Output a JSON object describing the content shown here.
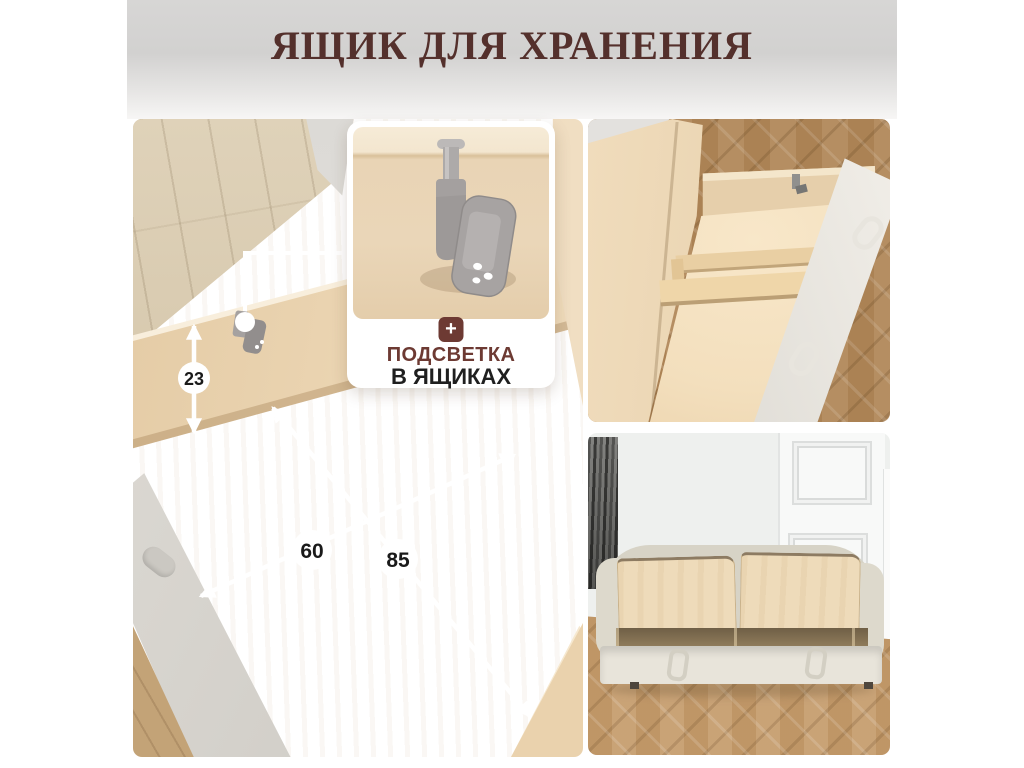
{
  "header": {
    "title": "ЯЩИК ДЛЯ ХРАНЕНИЯ",
    "title_color": "#54302c"
  },
  "callout": {
    "plus": "+",
    "line1": "ПОДСВЕТКА",
    "line2": "В ЯЩИКАХ",
    "accent_color": "#6d3a33",
    "card_background": "#ffffff"
  },
  "dimensions": {
    "height": "23",
    "width": "60",
    "depth": "85"
  },
  "icons": {
    "plus": "plus-icon",
    "sensor": "drawer-light-sensor-icon"
  },
  "colors": {
    "header_gray_top": "#d7d6d5",
    "header_gray_bottom": "#f7f6f5",
    "plywood": "#f0dcbd",
    "oak_floor_light": "#d6c7ac",
    "oak_floor_warm": "#b1885a",
    "fabric_gray": "#d5d2cc",
    "annotation_white": "#ffffff"
  }
}
